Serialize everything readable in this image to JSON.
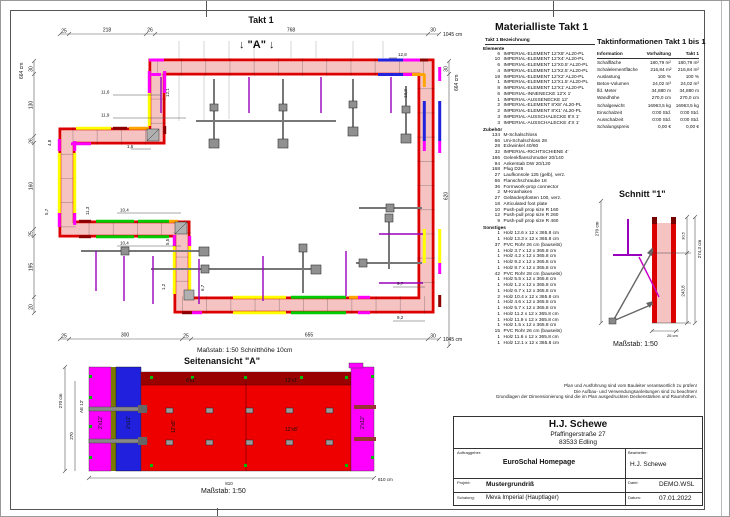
{
  "sheet": {
    "takt_title": "Takt 1",
    "section_arrow_label": "↓ \"A\" ↓"
  },
  "plan": {
    "scale_note": "Maßstab: 1:50   Schnitthöhe 10cm",
    "top_dims": [
      "25",
      "218",
      "26",
      "768",
      "30",
      "1045 cm"
    ],
    "left_dims": [
      "664 cm",
      "30",
      "130",
      "26",
      "160",
      "25",
      "195",
      "20"
    ],
    "right_dims": [
      "664 cm",
      "30",
      "620"
    ],
    "bottom_dims": [
      "25",
      "300",
      "25",
      "655",
      "30",
      "1045 cm"
    ],
    "filler_dims": [
      "12,8",
      "13,3",
      "11,6",
      "11,9",
      "12,1",
      "1,5",
      "4,8",
      "5,7",
      "11,3",
      "10,4",
      "10,4",
      "5,5",
      "1,2",
      "6,7",
      "9,7",
      "9,2"
    ]
  },
  "material_list": {
    "title": "Materialliste  Takt 1",
    "header": "Takt 1   Bezeichnung",
    "sections": [
      {
        "name": "Elemente",
        "items": [
          {
            "q": "6",
            "n": "IMPERIAL-ELEMENT 12'X8'  AL20-PL"
          },
          {
            "q": "10",
            "n": "IMPERIAL-ELEMENT 12'X4'  AL20-PL"
          },
          {
            "q": "6",
            "n": "IMPERIAL-ELEMENT 12'X0.5'  AL20-PL"
          },
          {
            "q": "4",
            "n": "IMPERIAL-ELEMENT 12'X2.5'  AL20-PL"
          },
          {
            "q": "19",
            "n": "IMPERIAL-ELEMENT 12'X2'  AL20-PL"
          },
          {
            "q": "1",
            "n": "IMPERIAL-ELEMENT 12'X1.5'  AL20-PL"
          },
          {
            "q": "8",
            "n": "IMPERIAL-ELEMENT 12'X1'  AL20-PL"
          },
          {
            "q": "6",
            "n": "IMPERIAL-INNENECKE  12'X 1'"
          },
          {
            "q": "1",
            "n": "IMPERIAL-AUSSENECKE  12'"
          },
          {
            "q": "2",
            "n": "IMPERIAL-ELEMENT 8'X8'  AL20-PL"
          },
          {
            "q": "2",
            "n": "IMPERIAL-ELEMENT 8'X1'  AL20-PL"
          },
          {
            "q": "3",
            "n": "IMPERIAL-AUSSCHALECKE  8'X 1'"
          },
          {
            "q": "3",
            "n": "IMPERIAL-AUSSCHALECKE  4'X 1'"
          }
        ]
      },
      {
        "name": "Zubehör",
        "items": [
          {
            "q": "134",
            "n": "M-Schalschloss"
          },
          {
            "q": "66",
            "n": "Uni-Schalschloss 28"
          },
          {
            "q": "28",
            "n": "Eckwinkel 40/60"
          },
          {
            "q": "32",
            "n": "IMPERIAL-RICHTSCHIENE  4'"
          },
          {
            "q": "166",
            "n": "Gelenkflanschmutter 20/140"
          },
          {
            "q": "94",
            "n": "Ankerstab DW 20/120"
          },
          {
            "q": "168",
            "n": "Plug D26"
          },
          {
            "q": "27",
            "n": "Laufkonsole 125 (gelb), verz."
          },
          {
            "q": "66",
            "n": "Flanschschraube 18"
          },
          {
            "q": "36",
            "n": "Formwork-prop connector"
          },
          {
            "q": "2",
            "n": "M-Kranhaken"
          },
          {
            "q": "27",
            "n": "Geländerpfosten 100, verz."
          },
          {
            "q": "18",
            "n": "Articulated foot plate"
          },
          {
            "q": "10",
            "n": "Push-pull prop size R 160"
          },
          {
            "q": "12",
            "n": "Push-pull prop size R 260"
          },
          {
            "q": "9",
            "n": "Push-pull prop size R 460"
          }
        ]
      },
      {
        "name": "Sonstiges",
        "items": [
          {
            "q": "1",
            "n": "Holz 12.6 x 12 x 365.8 cm"
          },
          {
            "q": "1",
            "n": "Holz 13.3 x 12 x 365.8 cm"
          },
          {
            "q": "37",
            "n": "PVC Rohr 26 cm (bauseits)"
          },
          {
            "q": "1",
            "n": "Holz 3.7 x 12 x 365.8 cm"
          },
          {
            "q": "1",
            "n": "Holz 4.2 x 12 x 365.8 cm"
          },
          {
            "q": "1",
            "n": "Holz 9.2 x 12 x 365.8 cm"
          },
          {
            "q": "1",
            "n": "Holz 8.7 x 12 x 365.8 cm"
          },
          {
            "q": "42",
            "n": "PVC Rohr 28 cm (bauseits)"
          },
          {
            "q": "1",
            "n": "Holz 5.5 x 12 x 365.8 cm"
          },
          {
            "q": "1",
            "n": "Holz 1.2 x 12 x 365.8 cm"
          },
          {
            "q": "1",
            "n": "Holz 6.7 x 12 x 365.8 cm"
          },
          {
            "q": "2",
            "n": "Holz 10.4 x 12 x 365.8 cm"
          },
          {
            "q": "1",
            "n": "Holz 4.6 x 12 x 365.8 cm"
          },
          {
            "q": "1",
            "n": "Holz 5.7 x 12 x 365.8 cm"
          },
          {
            "q": "1",
            "n": "Holz 11.2 x 12 x 365.8 cm"
          },
          {
            "q": "1",
            "n": "Holz 11.9 x 12 x 365.8 cm"
          },
          {
            "q": "1",
            "n": "Holz 1.5 x 12 x 365.8 cm"
          },
          {
            "q": "15",
            "n": "PVC Rohr 26 cm (bauseits)"
          },
          {
            "q": "1",
            "n": "Holz 11.6 x 12 x 365.8 cm"
          },
          {
            "q": "1",
            "n": "Holz 12.1 x 12 x 365.8 cm"
          }
        ]
      }
    ]
  },
  "takt_info": {
    "title": "Taktinformationen  Takt 1 bis 1",
    "columns": {
      "info": "Information",
      "vorhaltung": "Vorhaltung",
      "takt1": "Takt 1"
    },
    "rows": [
      {
        "l": "Schalfläche",
        "a": "180,79 m²",
        "c": "180,79 m²"
      },
      {
        "l": "Schalelementfläche",
        "a": "216,84 m²",
        "c": "216,84 m²"
      },
      {
        "l": "Auslastung",
        "a": "100 %",
        "c": "100 %"
      },
      {
        "l": "Beton-Volumen",
        "a": "24,02 m³",
        "c": "24,02 m³"
      },
      {
        "l": "lfd. Meter",
        "a": "34,880 m",
        "c": "34,880 m"
      },
      {
        "l": "Wandhöhe",
        "a": "270,0 cm",
        "c": "270,0 cm"
      },
      {
        "l": "Schalgewicht",
        "a": "16963,5 kg",
        "c": "16963,5 kg"
      },
      {
        "l": "Einschalzeit",
        "a": "0:00 Std.",
        "c": "0:00 Std."
      },
      {
        "l": "Ausschalzeit",
        "a": "0:00 Std.",
        "c": "0:00 Std."
      },
      {
        "l": "Schalungspreis",
        "a": "0,00 €",
        "c": "0,00 €"
      }
    ]
  },
  "schnitt": {
    "title": "Schnitt \"1\"",
    "scale": "Maßstab: 1:50",
    "dim_height": "270 cm",
    "dim_total": "274,3 cm",
    "dim_top": "30,5",
    "dim_mid": "243,8",
    "dim_thickness": "26 cm"
  },
  "side_view": {
    "title": "Seitenansicht \"A\"",
    "scale": "Maßstab: 1:50",
    "dim_height": "270 cm",
    "dim_height2": "270",
    "dim_width": "810",
    "dim_width_label": "810 cm",
    "label_ae": "AE 12'",
    "el_labels": [
      "8'x1'",
      "12'x1'",
      "12'x8'",
      "12'x8'",
      "2'x12'",
      "2'x12'",
      "2'x12'"
    ]
  },
  "notes": [
    "Plan und Ausführung sind vom Bauleiter verantwortlich zu prüfen!",
    "Die Aufbau- und Verwendungsanleitungen sind zu beachten!",
    "Grundlagen der Dimensionierung sind die im Plan ausgedruckten Deckenstärken und Raumhöhen."
  ],
  "title_block": {
    "company": "H.J. Schewe",
    "street": "Pfaffingerstraße 27",
    "city": "83533 Edling",
    "auftraggeber_label": "Auftraggeber:",
    "auftraggeber": "EuroSchal Homepage",
    "bearbeiter_label": "Bearbeiter:",
    "bearbeiter": "H.J. Schewe",
    "projekt_label": "Projekt:",
    "projekt": "Mustergrundriß",
    "datei_label": "Datei:",
    "datei": "DEMO.WSL",
    "schalung_label": "Schalung:",
    "schalung": "Meva Imperial (Hauptlager)",
    "datum_label": "Datum:",
    "datum": "07.01.2022"
  }
}
